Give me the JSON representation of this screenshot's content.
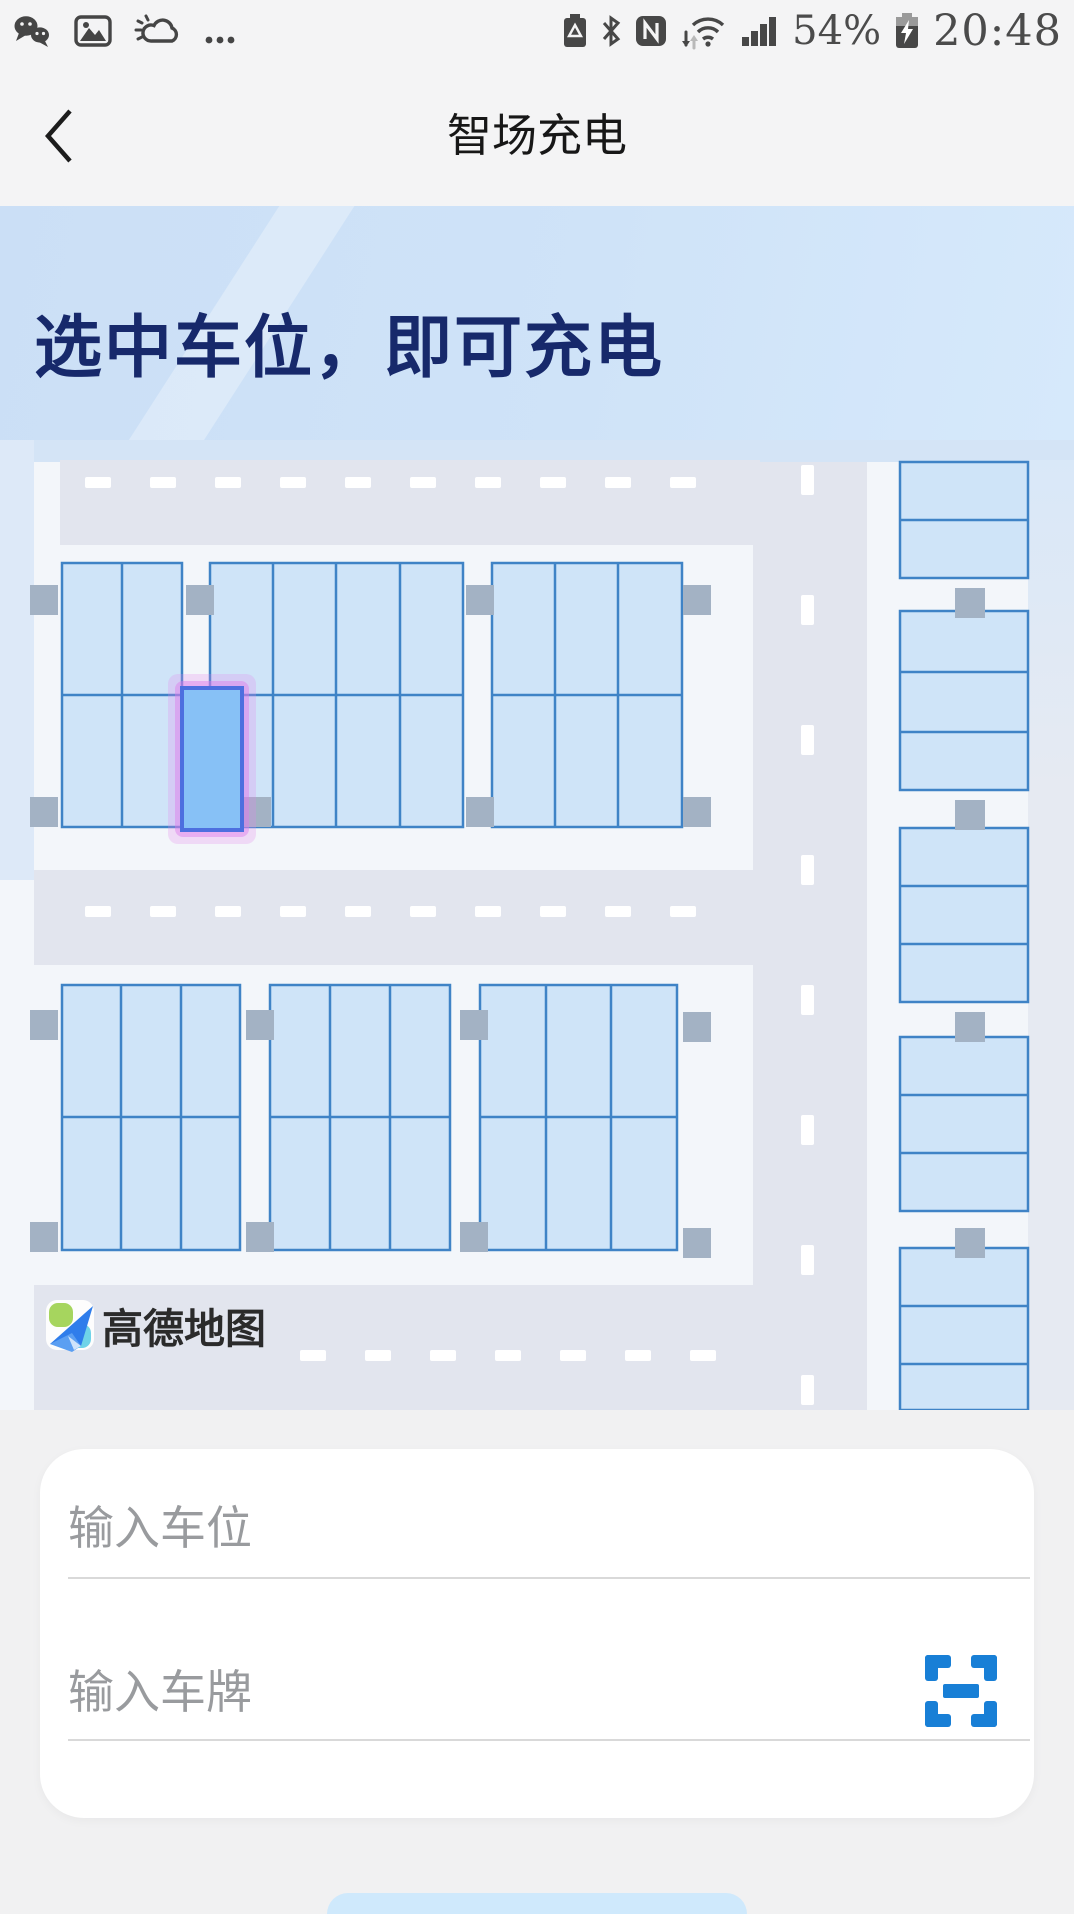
{
  "status_bar": {
    "time": "20:48",
    "battery": "54%",
    "left_icons": [
      "wechat",
      "gallery",
      "weather",
      "more"
    ],
    "right_icons": [
      "battery-saver",
      "bluetooth",
      "nfc",
      "wifi",
      "signal-bars",
      "battery-charging"
    ]
  },
  "nav": {
    "title": "智场充电",
    "back_icon": "chevron-left"
  },
  "hero": {
    "headline": "选中车位，即可充电"
  },
  "map": {
    "provider": "高德地图",
    "provider_icon": "amap-paper-plane",
    "selected_spot": {
      "state": "selected",
      "fill": "#87c1f6",
      "glow": "#e07ee8"
    }
  },
  "form": {
    "spot_placeholder": "输入车位",
    "spot_value": "",
    "plate_placeholder": "输入车牌",
    "plate_value": "",
    "scan_icon": "scan-frame"
  },
  "colors": {
    "accent_blue": "#187fd6",
    "headline_navy": "#17296b",
    "stall_fill": "#cfe4f8",
    "stall_border": "#3f83c6",
    "road": "#e2e5ee"
  }
}
